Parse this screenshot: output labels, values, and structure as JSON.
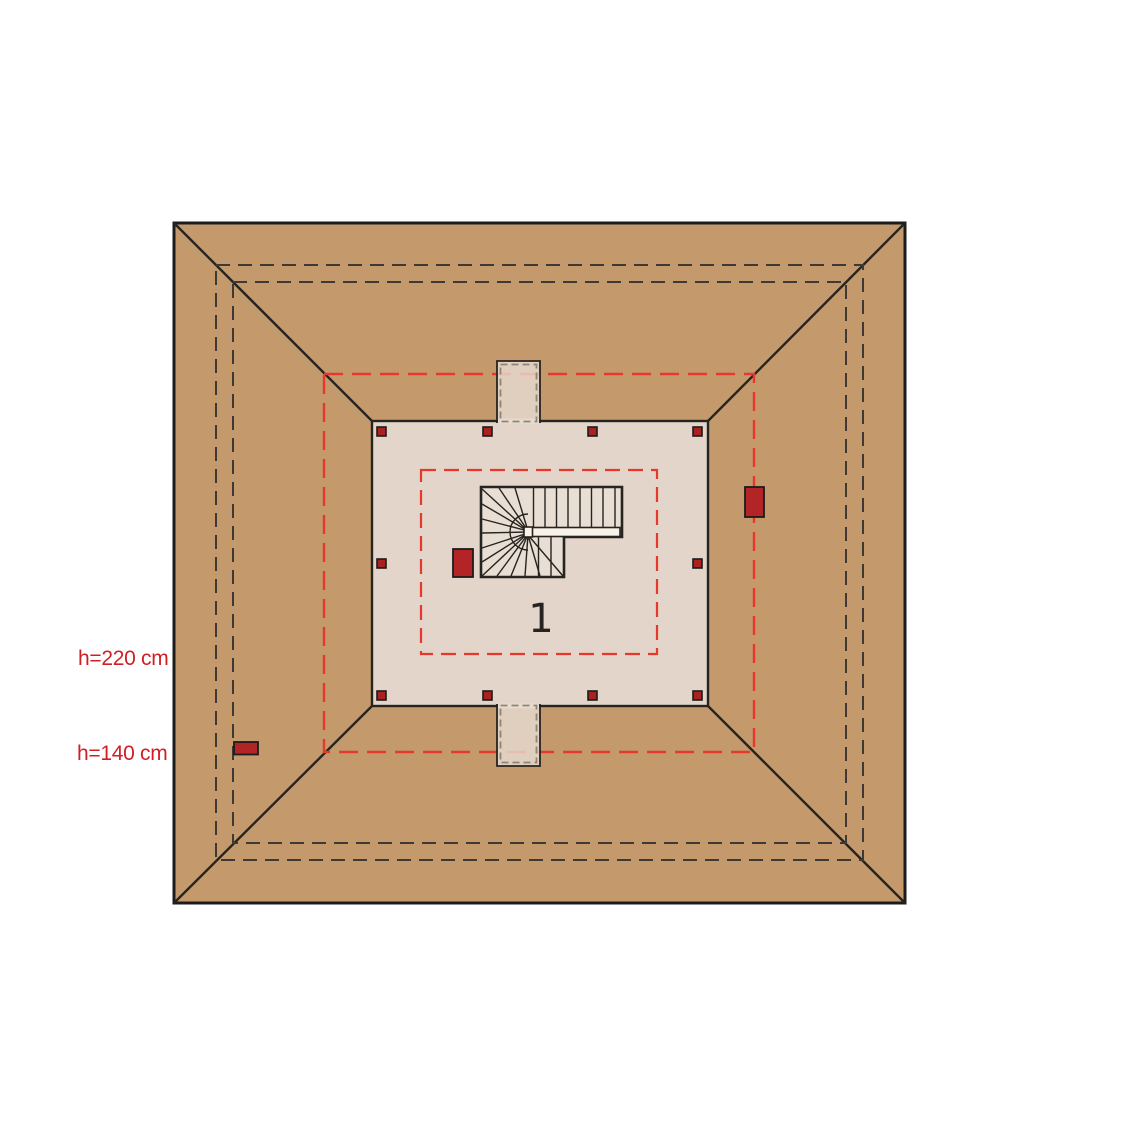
{
  "plan": {
    "type": "attic floor plan (hip roof, top view)",
    "room": {
      "number": "1"
    },
    "annotations": {
      "height_220": "h=220 cm",
      "height_140": "h=140 cm"
    },
    "contours": [
      {
        "label": "h=220 cm",
        "height_cm": 220,
        "style": "inner red dashed rectangle"
      },
      {
        "label": "h=140 cm",
        "height_cm": 140,
        "style": "outer red dashed rectangle"
      }
    ],
    "colors": {
      "roof": "#c49a6d",
      "floor": "#e3d5c9",
      "shaft": "#e7dbcf",
      "stair_fill": "#e9ded3",
      "rail_white": "#f8f2e8",
      "line_dark": "#262420",
      "outer_border": "#1c1c1c",
      "dash_dark": "#3e3a33",
      "dash_gray": "#8d8677",
      "contour_red": "#e6382c",
      "label_red": "#d01f24",
      "chimney_red": "#b22426",
      "post_red": "#a82220"
    }
  }
}
